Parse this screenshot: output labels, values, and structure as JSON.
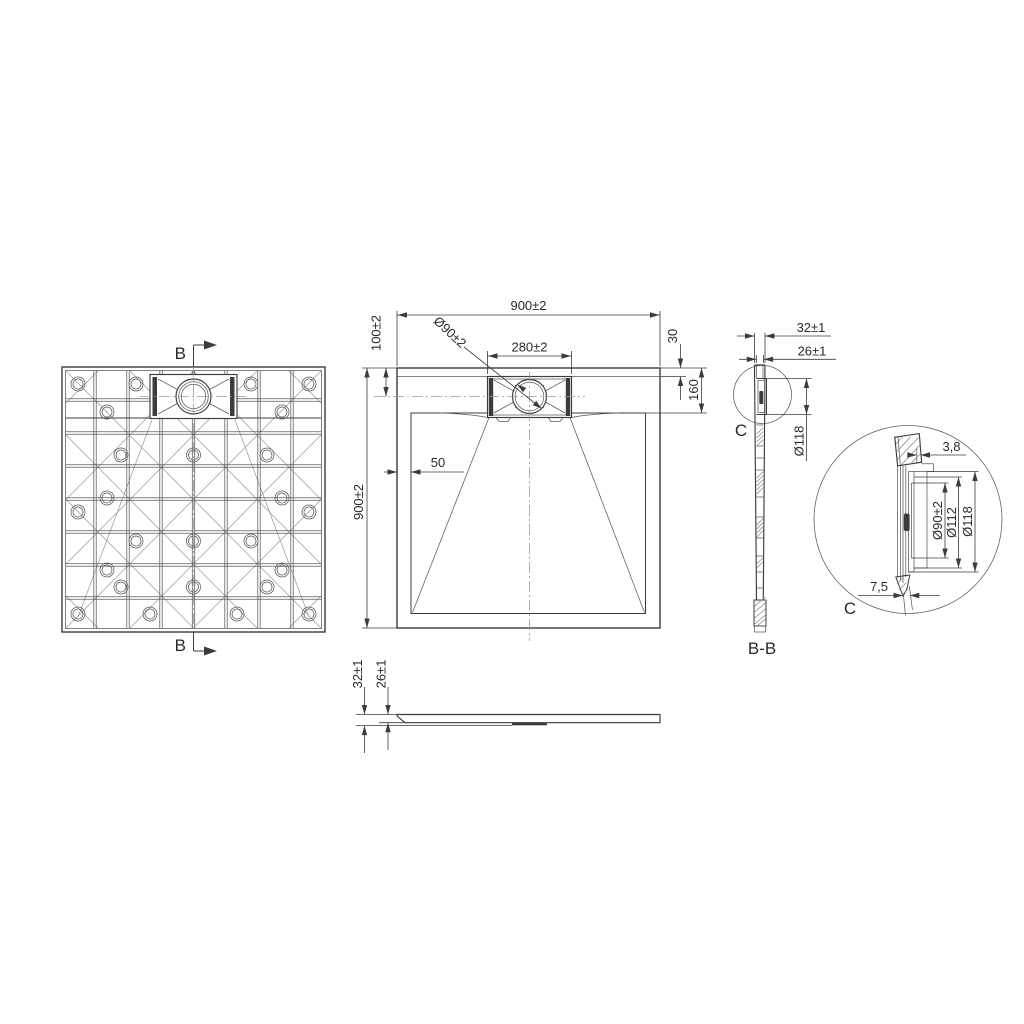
{
  "page": {
    "background": "#ffffff",
    "line_color": "#3c3c3c",
    "text_color": "#2a2a2a"
  },
  "views": {
    "bottom_view": {
      "section_marker_top": "B",
      "section_marker_bottom": "B"
    },
    "plan_view": {
      "dim_width": "900±2",
      "dim_height": "900±2",
      "dim_drain_center_offset": "100±2",
      "dim_drain_diameter": "Ø90±2",
      "dim_channel_width": "280±2",
      "dim_rim_to_channel": "30",
      "dim_rim_to_basin": "160",
      "dim_basin_inset": "50"
    },
    "front_view": {
      "dim_height_total": "32±1",
      "dim_height_rim": "26±1"
    },
    "section_view": {
      "label": "B-B",
      "dim_thickness_total": "32±1",
      "dim_thickness_rim": "26±1",
      "dim_flange_diameter": "Ø118",
      "detail_marker": "C"
    },
    "detail_view": {
      "label": "C",
      "dim_wall_thickness": "3,8",
      "dim_drain_bore": "Ø90±2",
      "dim_seat_diameter": "Ø112",
      "dim_flange_diameter": "Ø118",
      "dim_foot_offset": "7,5"
    }
  }
}
